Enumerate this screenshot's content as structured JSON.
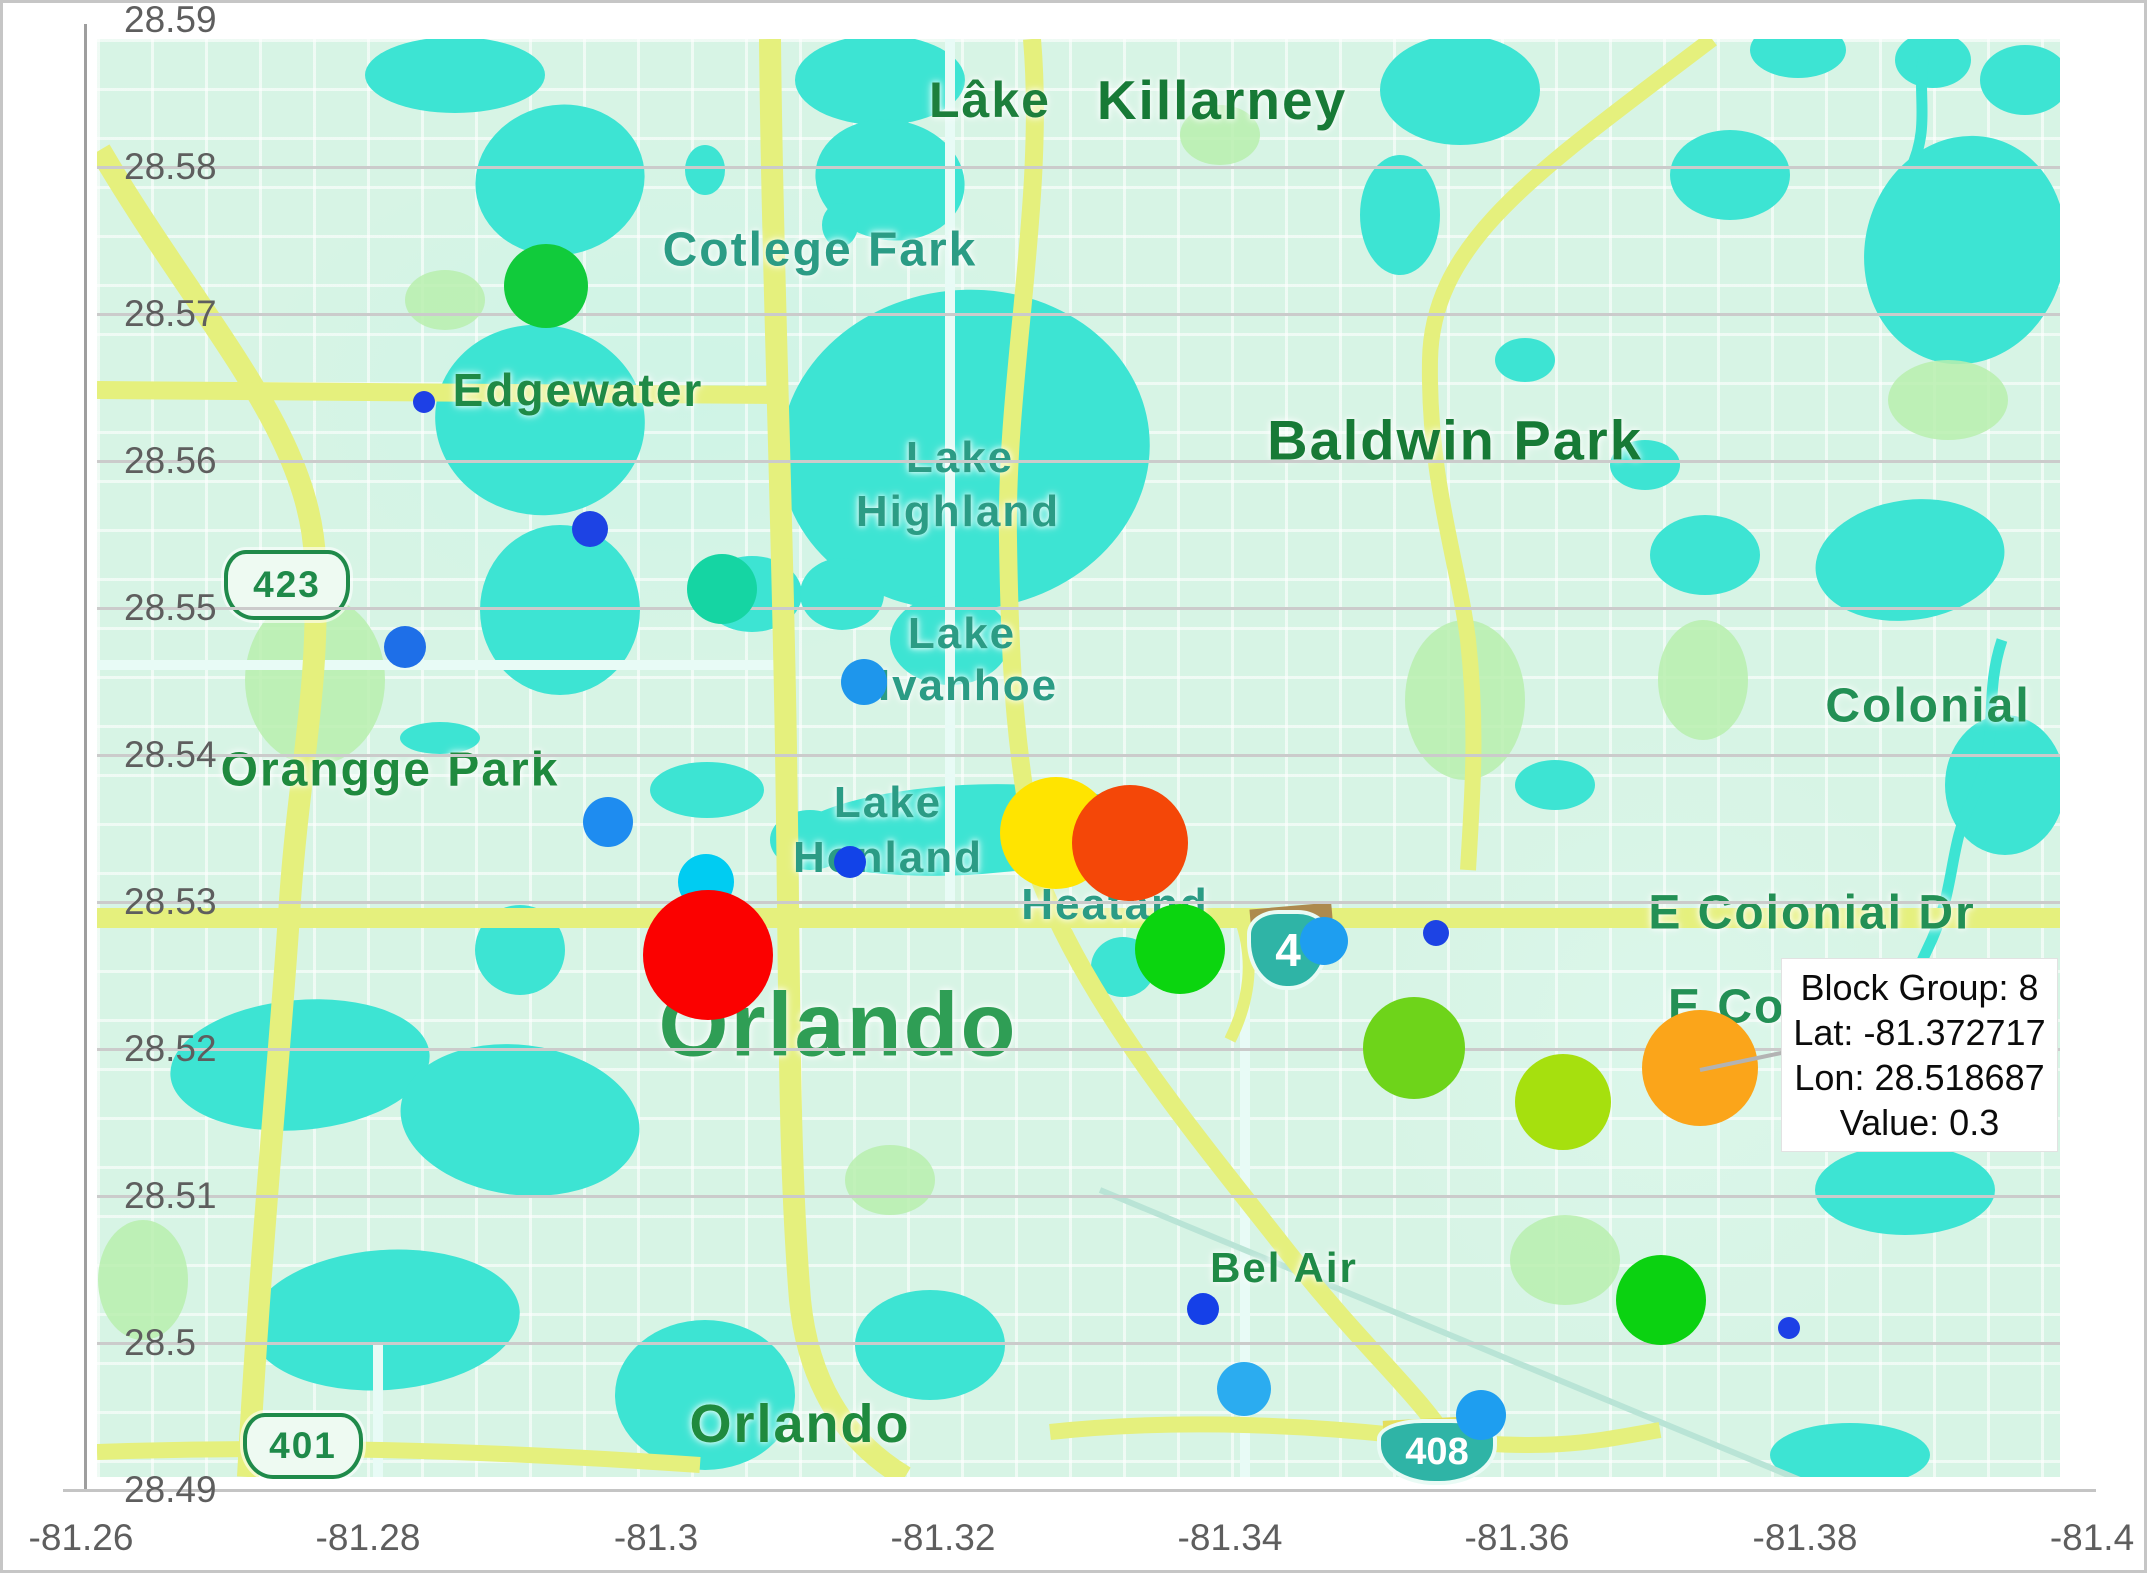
{
  "figure": {
    "width": 2147,
    "height": 1573,
    "background": "#ffffff",
    "border_color": "#c6c6c6"
  },
  "axes": {
    "tick_color": "#5e5e5e",
    "grid_color": "#cbcbcb",
    "y_ticks": [
      {
        "label": "28.59",
        "y": 20
      },
      {
        "label": "28.58",
        "y": 167
      },
      {
        "label": "28.57",
        "y": 314
      },
      {
        "label": "28.56",
        "y": 461
      },
      {
        "label": "28.55",
        "y": 608
      },
      {
        "label": "28.54",
        "y": 755
      },
      {
        "label": "28.53",
        "y": 902
      },
      {
        "label": "28.52",
        "y": 1049
      },
      {
        "label": "28.51",
        "y": 1196
      },
      {
        "label": "28.5",
        "y": 1343
      },
      {
        "label": "28.49",
        "y": 1490
      }
    ],
    "x_ticks": [
      {
        "label": "-81.26",
        "x": 81
      },
      {
        "label": "-81.28",
        "x": 368
      },
      {
        "label": "-81.3",
        "x": 656
      },
      {
        "label": "-81.32",
        "x": 943
      },
      {
        "label": "-81.34",
        "x": 1230
      },
      {
        "label": "-81.36",
        "x": 1517
      },
      {
        "label": "-81.38",
        "x": 1805
      },
      {
        "label": "-81.4",
        "x": 2092
      }
    ]
  },
  "map": {
    "labels": [
      {
        "text": "Lâke",
        "x": 990,
        "y": 100,
        "size": 50,
        "color": "#1d7f3c",
        "weight": 700
      },
      {
        "text": "Killarney",
        "x": 1222,
        "y": 100,
        "size": 55,
        "color": "#177a36",
        "weight": 700
      },
      {
        "text": "Cotlege Fark",
        "x": 820,
        "y": 250,
        "size": 48,
        "color": "#2b9c85",
        "weight": 600
      },
      {
        "text": "Edgewater",
        "x": 578,
        "y": 390,
        "size": 46,
        "color": "#1f8a46",
        "weight": 600
      },
      {
        "text": "Baldwin Park",
        "x": 1455,
        "y": 440,
        "size": 56,
        "color": "#177a36",
        "weight": 700
      },
      {
        "text": "Lake",
        "x": 960,
        "y": 458,
        "size": 44,
        "color": "#2b9c85",
        "weight": 600
      },
      {
        "text": "Highland",
        "x": 958,
        "y": 512,
        "size": 44,
        "color": "#2b9c85",
        "weight": 600
      },
      {
        "text": "Lake",
        "x": 962,
        "y": 634,
        "size": 44,
        "color": "#2b9c85",
        "weight": 600
      },
      {
        "text": "Ivanhoe",
        "x": 968,
        "y": 686,
        "size": 44,
        "color": "#2b9c85",
        "weight": 600
      },
      {
        "text": "Colonial",
        "x": 1928,
        "y": 706,
        "size": 48,
        "color": "#239055",
        "weight": 600
      },
      {
        "text": "Orangge Park",
        "x": 390,
        "y": 770,
        "size": 48,
        "color": "#1f8a3e",
        "weight": 600
      },
      {
        "text": "Lake",
        "x": 888,
        "y": 803,
        "size": 44,
        "color": "#2b9c85",
        "weight": 600
      },
      {
        "text": "Honland",
        "x": 888,
        "y": 858,
        "size": 44,
        "color": "#2b9c85",
        "weight": 600
      },
      {
        "text": "Heatand",
        "x": 1115,
        "y": 905,
        "size": 44,
        "color": "#2b9c85",
        "weight": 600
      },
      {
        "text": "E Colonial Dr",
        "x": 1812,
        "y": 913,
        "size": 48,
        "color": "#239055",
        "weight": 600
      },
      {
        "text": "E Colonial",
        "x": 1668,
        "y": 1007,
        "size": 48,
        "color": "#239055",
        "weight": 600,
        "cut": true
      },
      {
        "text": "Orlando",
        "x": 838,
        "y": 1026,
        "size": 90,
        "color": "#2f9e55",
        "weight": 700
      },
      {
        "text": "Bel Air",
        "x": 1284,
        "y": 1268,
        "size": 42,
        "color": "#1f8a46",
        "weight": 600
      },
      {
        "text": "Orlando",
        "x": 800,
        "y": 1424,
        "size": 54,
        "color": "#1f8a3e",
        "weight": 700
      }
    ],
    "shields": [
      {
        "type": "us",
        "text": "423",
        "x": 287,
        "y": 585,
        "w": 118,
        "h": 62
      },
      {
        "type": "us",
        "text": "401",
        "x": 303,
        "y": 1446,
        "w": 112,
        "h": 58
      },
      {
        "type": "interstate",
        "text": "4",
        "x": 1288,
        "y": 950,
        "w": 74,
        "h": 72
      },
      {
        "type": "interstate",
        "text": "408",
        "x": 1437,
        "y": 1452,
        "w": 112,
        "h": 58
      }
    ]
  },
  "tooltip": {
    "x": 1781,
    "y": 958,
    "w": 275,
    "h": 192,
    "lines": [
      "Block Group: 8",
      "Lat: -81.372717",
      "Lon: 28.518687",
      "Value: 0.3"
    ],
    "anchor": {
      "x": 1700,
      "y": 1068,
      "x2": 1786,
      "y2": 1050
    }
  },
  "chart_data": {
    "type": "scatter",
    "title": "",
    "xlabel": "",
    "ylabel": "",
    "x_axis": {
      "range": [
        -81.26,
        -81.4
      ],
      "reversed": true,
      "ticks": [
        -81.26,
        -81.28,
        -81.3,
        -81.32,
        -81.34,
        -81.36,
        -81.38,
        -81.4
      ]
    },
    "y_axis": {
      "range": [
        28.49,
        28.59
      ],
      "ticks": [
        28.59,
        28.58,
        28.57,
        28.56,
        28.55,
        28.54,
        28.53,
        28.52,
        28.51,
        28.5,
        28.49
      ]
    },
    "grid": "horizontal-only",
    "basemap": "Orlando FL street map",
    "highlighted_point": {
      "block_group": 8,
      "lat": -81.372717,
      "lon": 28.518687,
      "value": 0.3
    },
    "points": [
      {
        "lon": -81.2924,
        "lat": 28.5719,
        "px": 546,
        "py": 286,
        "r": 42,
        "color": "#11cb3b"
      },
      {
        "lon": -81.2839,
        "lat": 28.564,
        "px": 424,
        "py": 402,
        "r": 11,
        "color": "#1d40e6"
      },
      {
        "lon": -81.2954,
        "lat": 28.5554,
        "px": 590,
        "py": 529,
        "r": 18,
        "color": "#1d43e4"
      },
      {
        "lon": -81.3046,
        "lat": 28.5513,
        "px": 722,
        "py": 589,
        "r": 35,
        "color": "#15d5a3"
      },
      {
        "lon": -81.2826,
        "lat": 28.5473,
        "px": 405,
        "py": 647,
        "r": 21,
        "color": "#1e6fe8"
      },
      {
        "lon": -81.3145,
        "lat": 28.545,
        "px": 864,
        "py": 682,
        "r": 23,
        "color": "#1e96ec"
      },
      {
        "lon": -81.2967,
        "lat": 28.5354,
        "px": 608,
        "py": 822,
        "r": 25,
        "color": "#1e8cf0"
      },
      {
        "lon": -81.3135,
        "lat": 28.5327,
        "px": 850,
        "py": 862,
        "r": 16,
        "color": "#1243e8"
      },
      {
        "lon": -81.3035,
        "lat": 28.5314,
        "px": 706,
        "py": 882,
        "r": 28,
        "color": "#00ccf2"
      },
      {
        "lon": -81.3279,
        "lat": 28.5347,
        "px": 1056,
        "py": 833,
        "r": 56,
        "color": "#ffe400"
      },
      {
        "lon": -81.333,
        "lat": 28.534,
        "px": 1130,
        "py": 843,
        "r": 58,
        "color": "#f44708"
      },
      {
        "lon": -81.3037,
        "lat": 28.5264,
        "px": 708,
        "py": 955,
        "r": 65,
        "color": "#fb0100"
      },
      {
        "lon": -81.3365,
        "lat": 28.5268,
        "px": 1180,
        "py": 949,
        "r": 45,
        "color": "#0bd50f"
      },
      {
        "lon": -81.3465,
        "lat": 28.5273,
        "px": 1324,
        "py": 941,
        "r": 24,
        "color": "#1e9ef0"
      },
      {
        "lon": -81.3543,
        "lat": 28.5279,
        "px": 1436,
        "py": 933,
        "r": 13,
        "color": "#1d43e4"
      },
      {
        "lon": -81.3528,
        "lat": 28.5201,
        "px": 1414,
        "py": 1048,
        "r": 51,
        "color": "#6ed41a"
      },
      {
        "lon": -81.3632,
        "lat": 28.5164,
        "px": 1563,
        "py": 1102,
        "r": 48,
        "color": "#a6e00e"
      },
      {
        "lon": -81.372717,
        "lat": 28.518687,
        "px": 1700,
        "py": 1068,
        "r": 58,
        "color": "#fba51a",
        "value": 0.3,
        "block_group": 8,
        "highlighted": true
      },
      {
        "lon": -81.3707,
        "lat": 28.5029,
        "px": 1661,
        "py": 1300,
        "r": 45,
        "color": "#0bd211"
      },
      {
        "lon": -81.3796,
        "lat": 28.501,
        "px": 1789,
        "py": 1328,
        "r": 11,
        "color": "#1d40e6"
      },
      {
        "lon": -81.3381,
        "lat": 28.5023,
        "px": 1203,
        "py": 1309,
        "r": 16,
        "color": "#1540e8"
      },
      {
        "lon": -81.341,
        "lat": 28.4969,
        "px": 1244,
        "py": 1389,
        "r": 27,
        "color": "#2bacf0"
      },
      {
        "lon": -81.3575,
        "lat": 28.4951,
        "px": 1481,
        "py": 1415,
        "r": 25,
        "color": "#1e9ef0"
      }
    ]
  }
}
